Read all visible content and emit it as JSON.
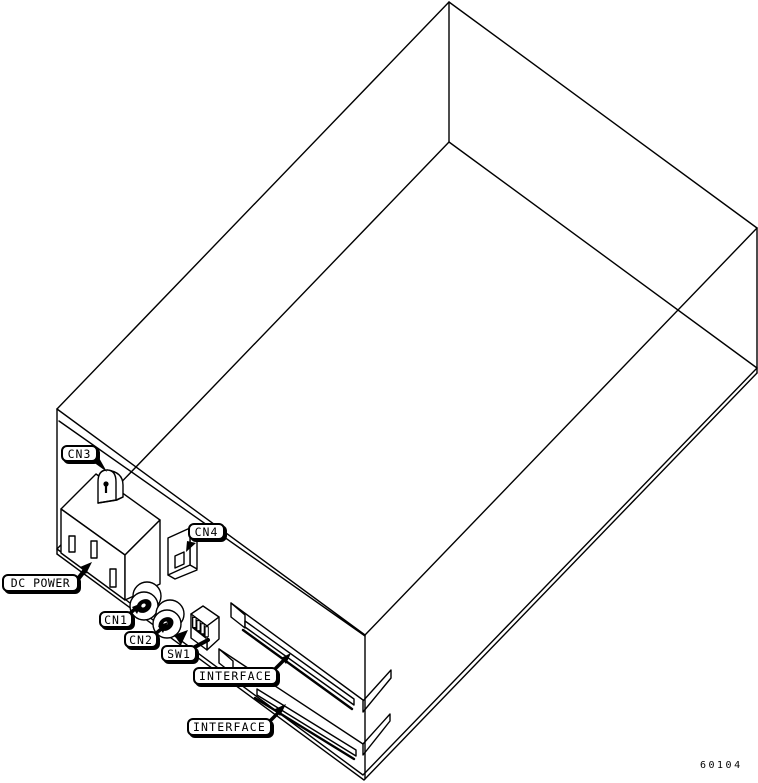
{
  "figure_number": "60104",
  "colors": {
    "line": "#000000",
    "background": "#ffffff"
  },
  "callouts": [
    {
      "id": "cn3",
      "text": "CN3",
      "target": "cn3-connector"
    },
    {
      "id": "cn4",
      "text": "CN4",
      "target": "cn4-connector"
    },
    {
      "id": "dc_power",
      "text": "DC POWER",
      "target": "dc-power-outlet"
    },
    {
      "id": "cn1",
      "text": "CN1",
      "target": "cn1-jack"
    },
    {
      "id": "cn2",
      "text": "CN2",
      "target": "cn2-jack"
    },
    {
      "id": "sw1",
      "text": "SW1",
      "target": "sw1-dip-switch"
    },
    {
      "id": "interface_upper",
      "text": "INTERFACE",
      "target": "interface-slot-upper"
    },
    {
      "id": "interface_lower",
      "text": "INTERFACE",
      "target": "interface-slot-lower"
    }
  ],
  "parts": [
    "chassis-wireframe",
    "dc-power-outlet",
    "cn3-connector",
    "cn4-connector",
    "cn1-jack",
    "cn2-jack",
    "sw1-dip-switch",
    "interface-slot-upper",
    "interface-slot-lower"
  ]
}
